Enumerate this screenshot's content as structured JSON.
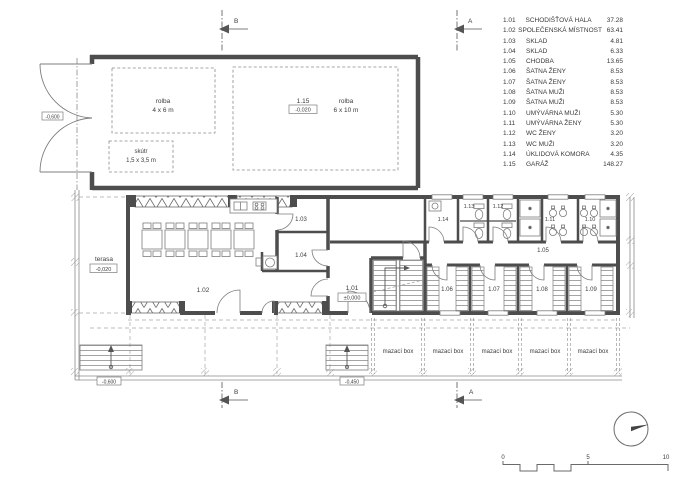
{
  "legend": {
    "rows": [
      {
        "num": "1.01",
        "name": "SCHODIŠŤOVÁ HALA",
        "area": "37.28"
      },
      {
        "num": "1.02",
        "name": "SPOLEČENSKÁ MÍSTNOST",
        "area": "63.41"
      },
      {
        "num": "1.03",
        "name": "SKLAD",
        "area": "4.81"
      },
      {
        "num": "1.04",
        "name": "SKLAD",
        "area": "6.33"
      },
      {
        "num": "1.05",
        "name": "CHODBA",
        "area": "13.65"
      },
      {
        "num": "1.06",
        "name": "ŠATNA ŽENY",
        "area": "8.53"
      },
      {
        "num": "1.07",
        "name": "ŠATNA ŽENY",
        "area": "8.53"
      },
      {
        "num": "1.08",
        "name": "ŠATNA MUŽI",
        "area": "8.53"
      },
      {
        "num": "1.09",
        "name": "ŠATNA MUŽI",
        "area": "8.53"
      },
      {
        "num": "1.10",
        "name": "UMÝVÁRNA MUŽI",
        "area": "5.30"
      },
      {
        "num": "1.11",
        "name": "UMÝVÁRNA ŽENY",
        "area": "5.30"
      },
      {
        "num": "1.12",
        "name": "WC ŽENY",
        "area": "3.20"
      },
      {
        "num": "1.13",
        "name": "WC MUŽI",
        "area": "3.20"
      },
      {
        "num": "1.14",
        "name": "ÚKLIDOVÁ KOMORA",
        "area": "4.35"
      },
      {
        "num": "1.15",
        "name": "GARÁŽ",
        "area": "148.27"
      }
    ]
  },
  "plan": {
    "rooms": {
      "r101": "1.01",
      "r102": "1.02",
      "r103": "1.03",
      "r104": "1.04",
      "r105": "1.05",
      "r106": "1.06",
      "r107": "1.07",
      "r108": "1.08",
      "r109": "1.09",
      "r110": "1.10",
      "r111": "1.11",
      "r112": "1.12",
      "r113": "1.13",
      "r114": "1.14",
      "r115": "1.15"
    },
    "levels": {
      "main": "±0,000",
      "garage": "-0,020",
      "terasa": "-0,020",
      "terrain_door": "-0,600",
      "stairs_left": "-0,600",
      "terrain_front": "-0,450"
    },
    "labels": {
      "terasa": "terasa",
      "mazaci_box": "mazací box",
      "rolba": "rolba",
      "rolba_small_dim": "4 x 6 m",
      "rolba_big_dim": "6 x 10 m",
      "skutr": "skútr",
      "skutr_dim": "1,5 x 3,5 m"
    },
    "sections": {
      "a": "A",
      "b": "B"
    },
    "scalebar": {
      "zero": "0",
      "five": "5",
      "ten": "10"
    }
  },
  "colors": {
    "wall": "#4d4d4d",
    "thin_line": "#828282",
    "dashed_line": "#a8a8a8",
    "text": "#3c3c3c"
  }
}
